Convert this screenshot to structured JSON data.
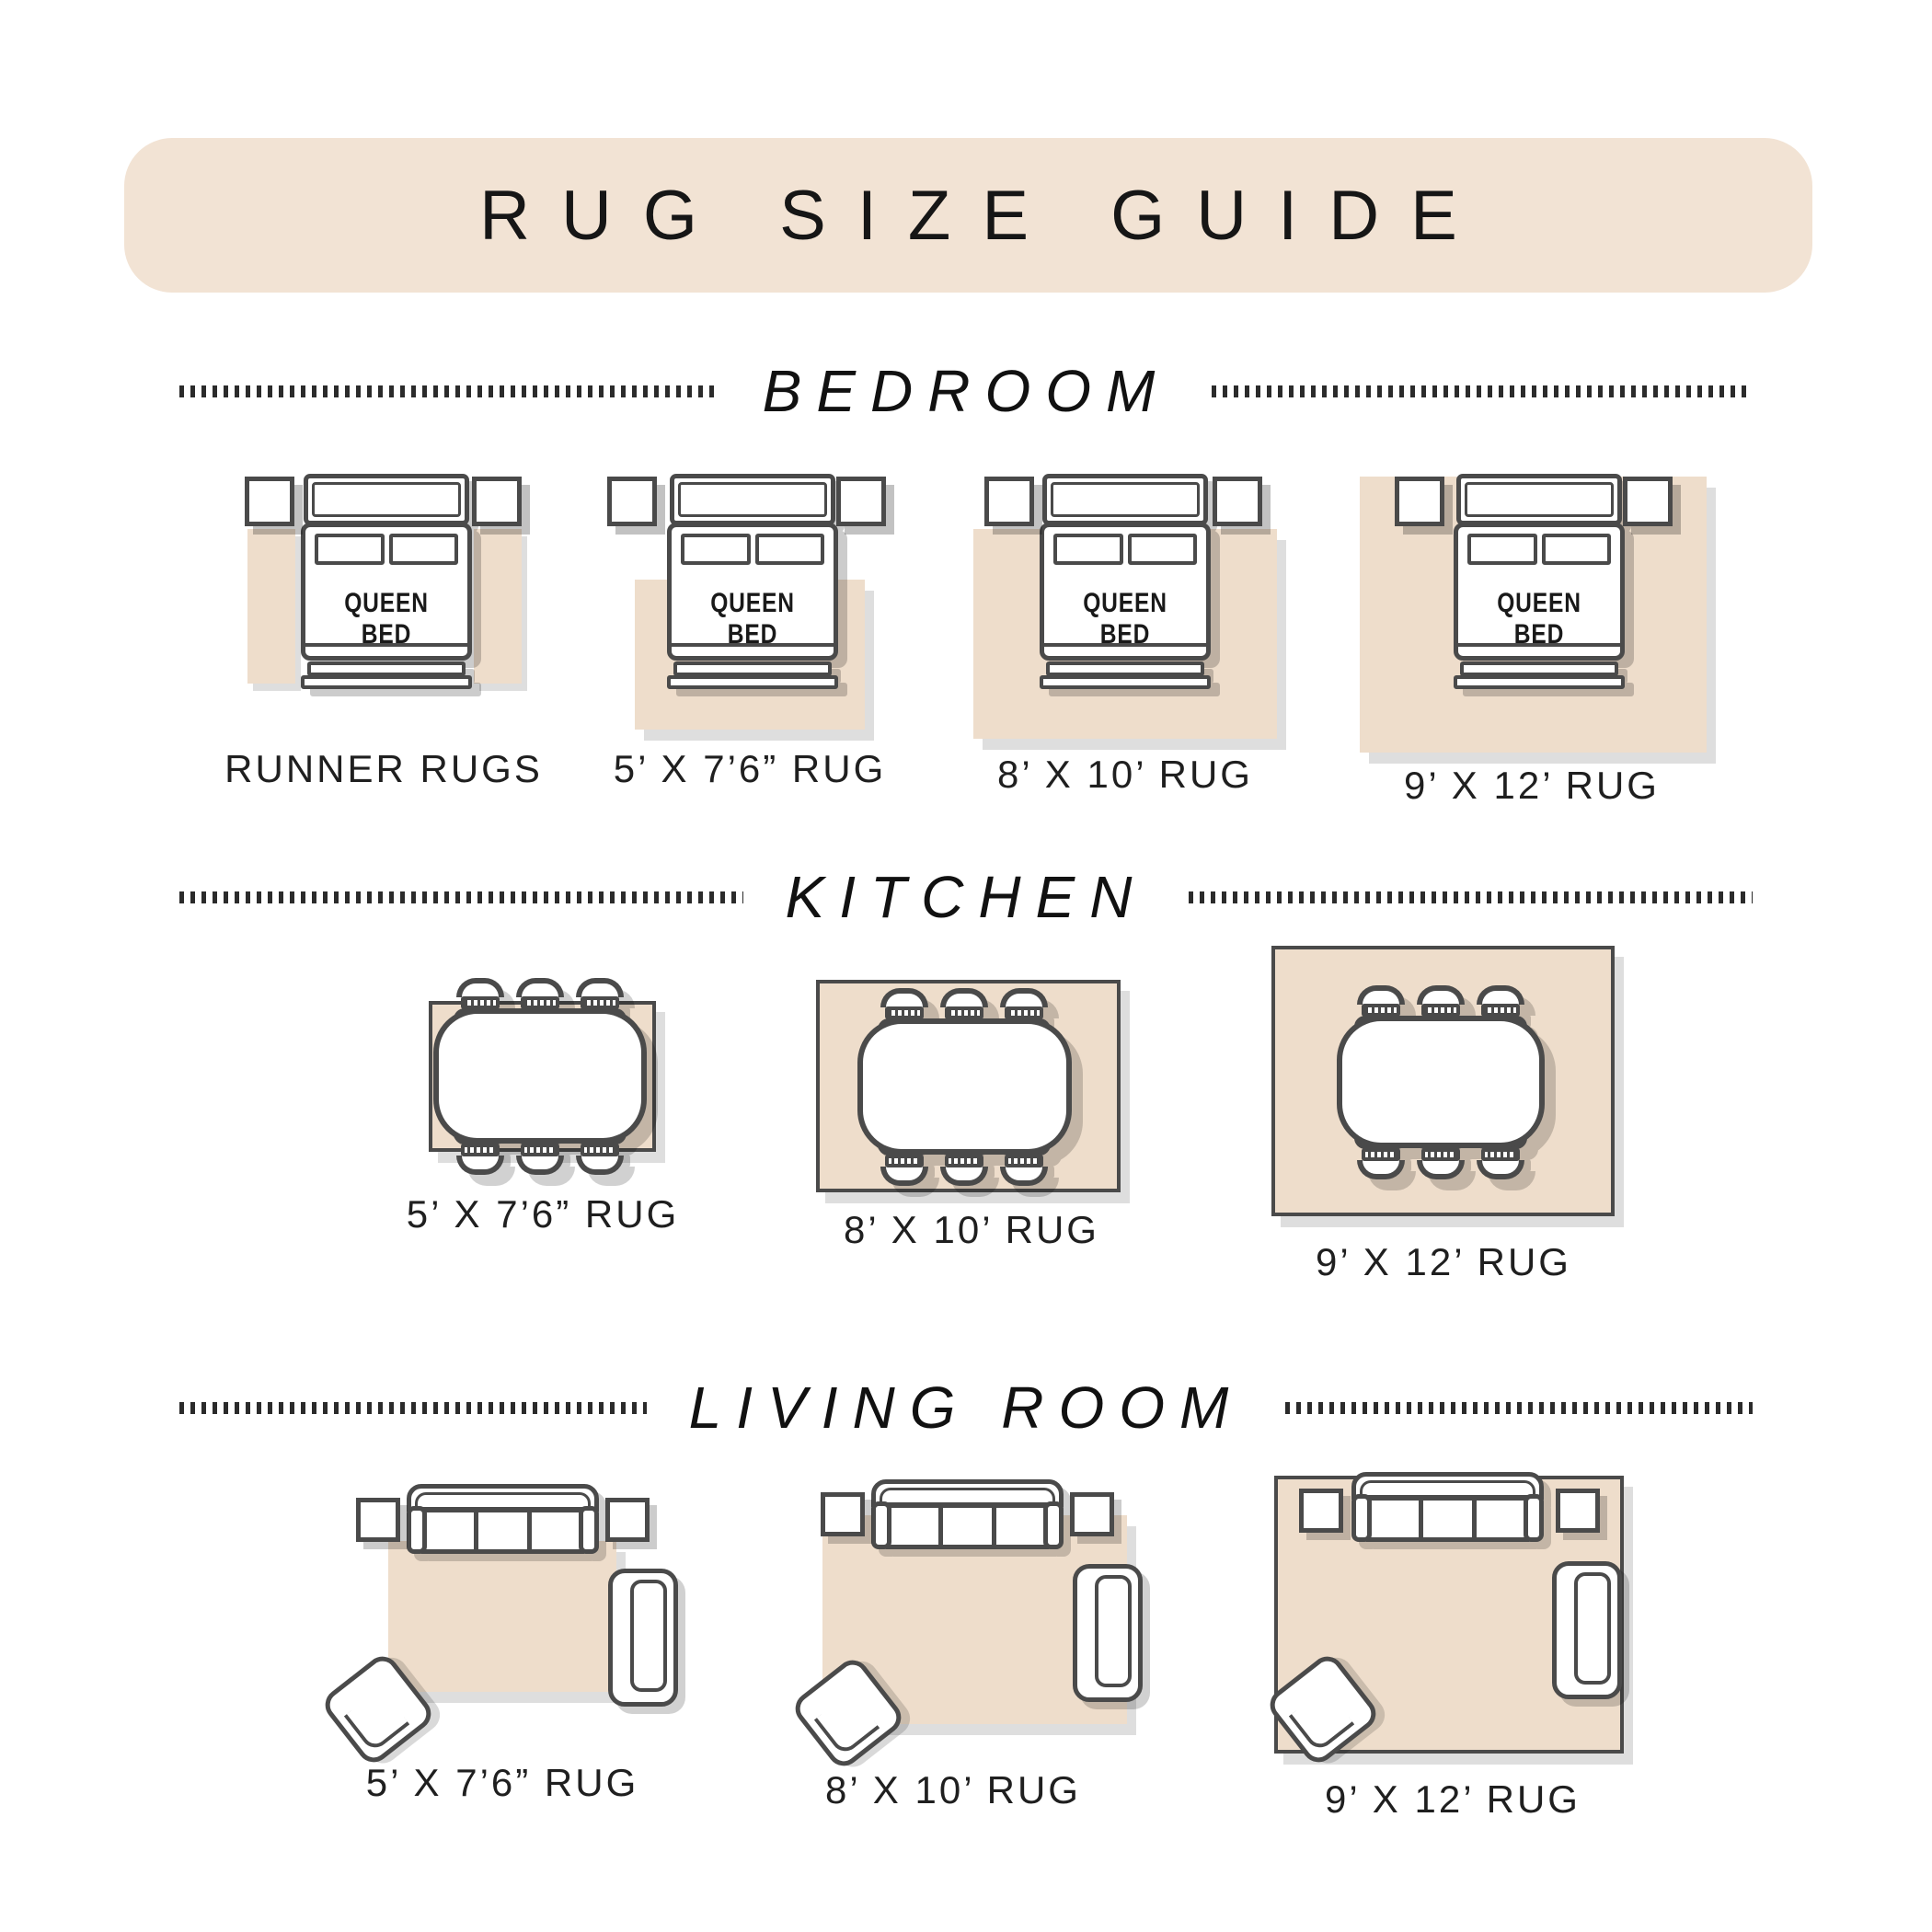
{
  "title": "RUG SIZE GUIDE",
  "bed_label": "QUEEN BED",
  "colors": {
    "pill_bg": "#f2e3d4",
    "rug_bg": "#eeddcb",
    "outline": "#4a4a4a",
    "text": "#1f1f1f"
  },
  "sections": [
    {
      "label": "BEDROOM",
      "items": [
        {
          "caption": "RUNNER RUGS"
        },
        {
          "caption": "5’ X 7’6” RUG"
        },
        {
          "caption": "8’ X 10’ RUG"
        },
        {
          "caption": "9’ X 12’ RUG"
        }
      ]
    },
    {
      "label": "KITCHEN",
      "items": [
        {
          "caption": "5’ X 7’6” RUG"
        },
        {
          "caption": "8’ X 10’ RUG"
        },
        {
          "caption": "9’ X 12’ RUG"
        }
      ]
    },
    {
      "label": "LIVING ROOM",
      "items": [
        {
          "caption": "5’ X 7’6” RUG"
        },
        {
          "caption": "8’ X 10’ RUG"
        },
        {
          "caption": "9’ X 12’ RUG"
        }
      ]
    }
  ]
}
